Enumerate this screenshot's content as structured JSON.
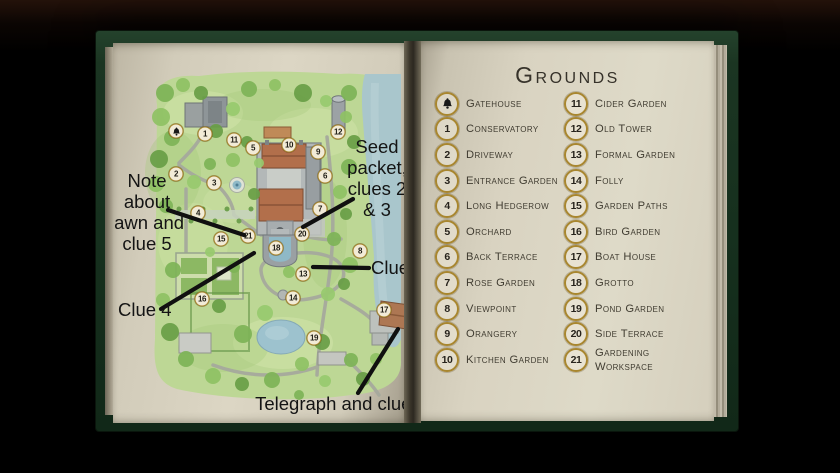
{
  "scene": {
    "description": "Open guide book: hand-drawn grounds map with clue annotations on left page, numbered legend on right page"
  },
  "colors": {
    "background": "#000000",
    "cover_green": "#16301e",
    "page_cream": "#dcd6c4",
    "legend_gold": "#a8862f",
    "legend_ink": "#403c31",
    "annotation_ink": "#141414",
    "map_green": "#bdd795",
    "water_blue": "#a9c6cc",
    "roof_red": "#b26f4b"
  },
  "legend": {
    "title": "Grounds",
    "left_column": [
      {
        "icon": "bell",
        "label": "Gatehouse"
      },
      {
        "num": "1",
        "label": "Conservatory"
      },
      {
        "num": "2",
        "label": "Driveway"
      },
      {
        "num": "3",
        "label": "Entrance Garden"
      },
      {
        "num": "4",
        "label": "Long Hedgerow"
      },
      {
        "num": "5",
        "label": "Orchard"
      },
      {
        "num": "6",
        "label": "Back Terrace"
      },
      {
        "num": "7",
        "label": "Rose Garden"
      },
      {
        "num": "8",
        "label": "Viewpoint"
      },
      {
        "num": "9",
        "label": "Orangery"
      },
      {
        "num": "10",
        "label": "Kitchen Garden"
      }
    ],
    "right_column": [
      {
        "num": "11",
        "label": "Cider Garden"
      },
      {
        "num": "12",
        "label": "Old Tower"
      },
      {
        "num": "13",
        "label": "Formal Garden"
      },
      {
        "num": "14",
        "label": "Folly"
      },
      {
        "num": "15",
        "label": "Garden Paths"
      },
      {
        "num": "16",
        "label": "Bird Garden"
      },
      {
        "num": "17",
        "label": "Boat House"
      },
      {
        "num": "18",
        "label": "Grotto"
      },
      {
        "num": "19",
        "label": "Pond Garden"
      },
      {
        "num": "20",
        "label": "Side Terrace"
      },
      {
        "num": "21",
        "label": "Gardening Workspace"
      }
    ]
  },
  "map": {
    "markers": [
      {
        "icon": "bell",
        "label": "",
        "x": 63,
        "y": 88
      },
      {
        "label": "1",
        "x": 92,
        "y": 91
      },
      {
        "label": "2",
        "x": 63,
        "y": 131
      },
      {
        "label": "3",
        "x": 101,
        "y": 140
      },
      {
        "label": "4",
        "x": 85,
        "y": 170
      },
      {
        "label": "5",
        "x": 140,
        "y": 105
      },
      {
        "label": "6",
        "x": 212,
        "y": 133
      },
      {
        "label": "7",
        "x": 207,
        "y": 166
      },
      {
        "label": "8",
        "x": 247,
        "y": 208
      },
      {
        "label": "9",
        "x": 205,
        "y": 109
      },
      {
        "label": "10",
        "x": 176,
        "y": 102
      },
      {
        "label": "11",
        "x": 121,
        "y": 97
      },
      {
        "label": "12",
        "x": 225,
        "y": 89
      },
      {
        "label": "13",
        "x": 190,
        "y": 231
      },
      {
        "label": "14",
        "x": 180,
        "y": 255
      },
      {
        "label": "15",
        "x": 108,
        "y": 196
      },
      {
        "label": "16",
        "x": 89,
        "y": 256
      },
      {
        "label": "17",
        "x": 271,
        "y": 267
      },
      {
        "label": "18",
        "x": 163,
        "y": 205
      },
      {
        "label": "19",
        "x": 201,
        "y": 295
      },
      {
        "label": "20",
        "x": 189,
        "y": 191
      },
      {
        "label": "21",
        "x": 135,
        "y": 193
      }
    ],
    "annotations": [
      {
        "id": "note-lawn-clue5",
        "lines": [
          "Note",
          "about",
          "lawn and",
          "clue 5"
        ],
        "x": -4,
        "y": 127,
        "w": 76,
        "align": "center"
      },
      {
        "id": "seed-packet-clues-2-3",
        "lines": [
          "Seed",
          "packet,",
          "clues 2",
          "& 3"
        ],
        "x": 222,
        "y": 93,
        "w": 84,
        "align": "center"
      },
      {
        "id": "clue-1",
        "lines": [
          "Clue 1"
        ],
        "x": 258,
        "y": 214,
        "w": 64,
        "align": "left"
      },
      {
        "id": "clue-4",
        "lines": [
          "Clue 4"
        ],
        "x": 5,
        "y": 256,
        "w": 64,
        "align": "left"
      },
      {
        "id": "telegraph-clue-6",
        "lines": [
          "Telegraph and clue 6"
        ],
        "x": 140,
        "y": 350,
        "w": 176,
        "align": "center"
      }
    ],
    "pointer_lines": [
      [
        55,
        167,
        131,
        192
      ],
      [
        240,
        156,
        190,
        184
      ],
      [
        256,
        225,
        200,
        224
      ],
      [
        48,
        266,
        141,
        210
      ],
      [
        245,
        350,
        285,
        286
      ]
    ]
  }
}
